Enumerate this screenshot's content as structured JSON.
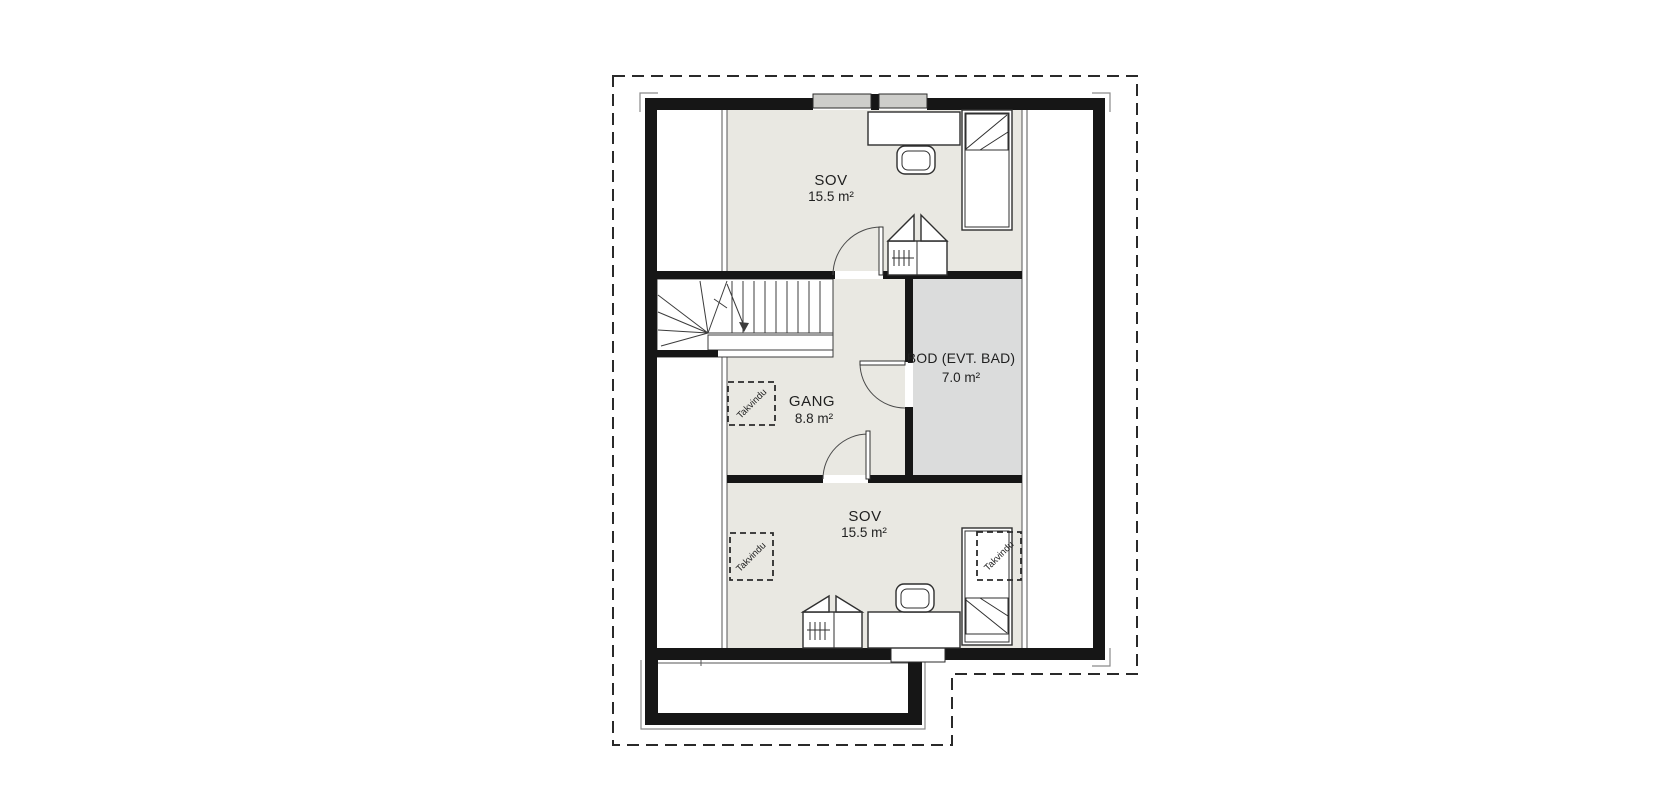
{
  "floor_plan": {
    "rooms": [
      {
        "id": "sov-top",
        "name": "SOV",
        "area": "15.5 m²"
      },
      {
        "id": "gang",
        "name": "GANG",
        "area": "8.8 m²"
      },
      {
        "id": "bod",
        "name": "BOD (EVT. BAD)",
        "area": "7.0 m²"
      },
      {
        "id": "sov-bottom",
        "name": "SOV",
        "area": "15.5 m²"
      }
    ],
    "skylight_label": "Takvindu",
    "colors": {
      "wall": "#161616",
      "floor": "#e9e8e2",
      "storage_floor": "#dbdcdc",
      "outline": "#2a2a2a",
      "window_fill": "#cdcdca",
      "background": "#ffffff"
    }
  }
}
